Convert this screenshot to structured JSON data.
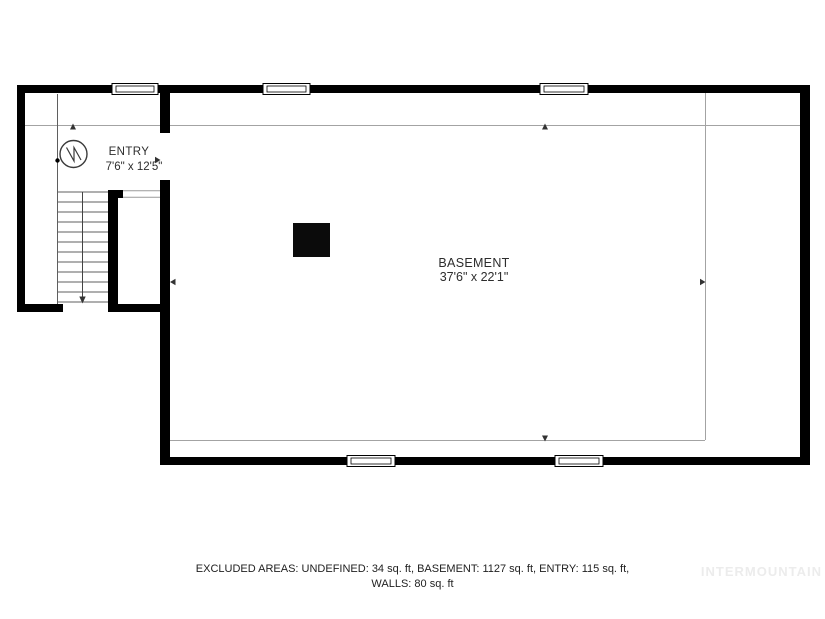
{
  "floorplan": {
    "rooms": {
      "entry": {
        "name": "ENTRY",
        "dims": "7'6\" x 12'5\""
      },
      "basement": {
        "name": "BASEMENT",
        "dims": "37'6\" x 22'1\""
      }
    },
    "footer": {
      "line1": "EXCLUDED AREAS: UNDEFINED: 34 sq. ft, BASEMENT: 1127 sq. ft, ENTRY: 115 sq. ft,",
      "line2": "WALLS: 80 sq. ft"
    },
    "watermark": "INTERMOUNTAIN",
    "colors": {
      "wall": "#000000",
      "guide_line": "#a3a3a3",
      "stair_line": "#5f5f5f",
      "label_text": "#2d2d2d",
      "watermark_text": "#ececec"
    }
  }
}
